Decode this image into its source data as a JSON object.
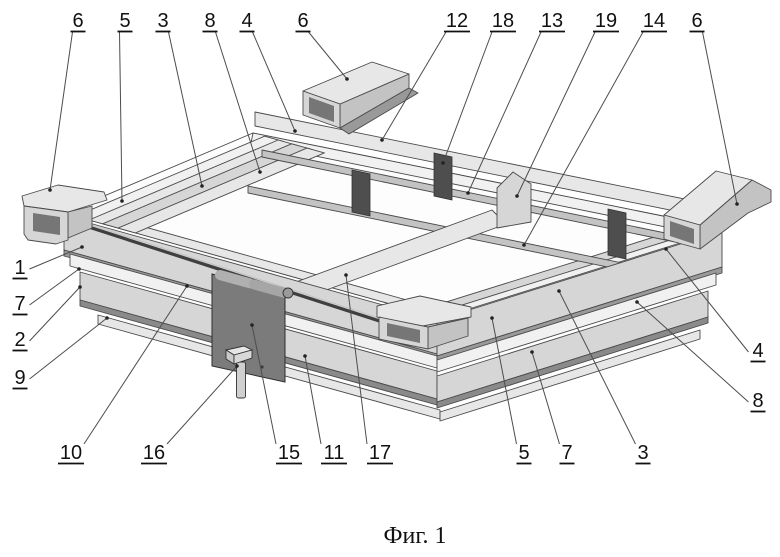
{
  "figure": {
    "caption": "Фиг. 1"
  },
  "colors": {
    "background": "#ffffff",
    "outline": "#4a4a4a",
    "leader": "#4d4d4d",
    "label_text": "#111111",
    "plate_gray": "#7b7b7b",
    "spacer_block_gray": "#4e4e4e",
    "metal_light_gray": "#e7e7e7",
    "metal_mid_gray": "#d6d6d6",
    "metal_shadow_gray": "#999999"
  },
  "labels": [
    {
      "text": "6",
      "side": "top",
      "x": 78,
      "y": 27,
      "tx": 50,
      "ty": 190
    },
    {
      "text": "5",
      "side": "top",
      "x": 125,
      "y": 27,
      "tx": 122,
      "ty": 201
    },
    {
      "text": "3",
      "side": "top",
      "x": 163,
      "y": 27,
      "tx": 202,
      "ty": 186
    },
    {
      "text": "8",
      "side": "top",
      "x": 210,
      "y": 27,
      "tx": 260,
      "ty": 172
    },
    {
      "text": "4",
      "side": "top",
      "x": 247,
      "y": 27,
      "tx": 295,
      "ty": 131
    },
    {
      "text": "6",
      "side": "top",
      "x": 303,
      "y": 27,
      "tx": 347,
      "ty": 79
    },
    {
      "text": "12",
      "side": "top",
      "x": 457,
      "y": 27,
      "tx": 382,
      "ty": 140
    },
    {
      "text": "18",
      "side": "top",
      "x": 503,
      "y": 27,
      "tx": 443,
      "ty": 163
    },
    {
      "text": "13",
      "side": "top",
      "x": 552,
      "y": 27,
      "tx": 468,
      "ty": 193
    },
    {
      "text": "19",
      "side": "top",
      "x": 606,
      "y": 27,
      "tx": 517,
      "ty": 196
    },
    {
      "text": "14",
      "side": "top",
      "x": 654,
      "y": 27,
      "tx": 524,
      "ty": 245
    },
    {
      "text": "6",
      "side": "top",
      "x": 697,
      "y": 27,
      "tx": 737,
      "ty": 204
    },
    {
      "text": "1",
      "side": "left",
      "x": 20,
      "y": 274,
      "tx": 82,
      "ty": 247
    },
    {
      "text": "7",
      "side": "left",
      "x": 20,
      "y": 310,
      "tx": 79,
      "ty": 269
    },
    {
      "text": "2",
      "side": "left",
      "x": 20,
      "y": 346,
      "tx": 80,
      "ty": 287
    },
    {
      "text": "9",
      "side": "left",
      "x": 20,
      "y": 384,
      "tx": 107,
      "ty": 318
    },
    {
      "text": "10",
      "side": "bottom",
      "x": 71,
      "y": 459,
      "tx": 187,
      "ty": 286
    },
    {
      "text": "16",
      "side": "bottom",
      "x": 154,
      "y": 459,
      "tx": 237,
      "ty": 366
    },
    {
      "text": "15",
      "side": "bottom",
      "x": 289,
      "y": 459,
      "tx": 252,
      "ty": 325
    },
    {
      "text": "11",
      "side": "bottom",
      "x": 334,
      "y": 459,
      "tx": 305,
      "ty": 356
    },
    {
      "text": "17",
      "side": "bottom",
      "x": 380,
      "y": 459,
      "tx": 346,
      "ty": 275
    },
    {
      "text": "5",
      "side": "bottom",
      "x": 524,
      "y": 459,
      "tx": 492,
      "ty": 318
    },
    {
      "text": "7",
      "side": "bottom",
      "x": 567,
      "y": 459,
      "tx": 532,
      "ty": 352
    },
    {
      "text": "3",
      "side": "bottom",
      "x": 643,
      "y": 459,
      "tx": 559,
      "ty": 291
    },
    {
      "text": "4",
      "side": "right",
      "x": 758,
      "y": 357,
      "tx": 666,
      "ty": 249
    },
    {
      "text": "8",
      "side": "right",
      "x": 758,
      "y": 407,
      "tx": 637,
      "ty": 302
    }
  ]
}
